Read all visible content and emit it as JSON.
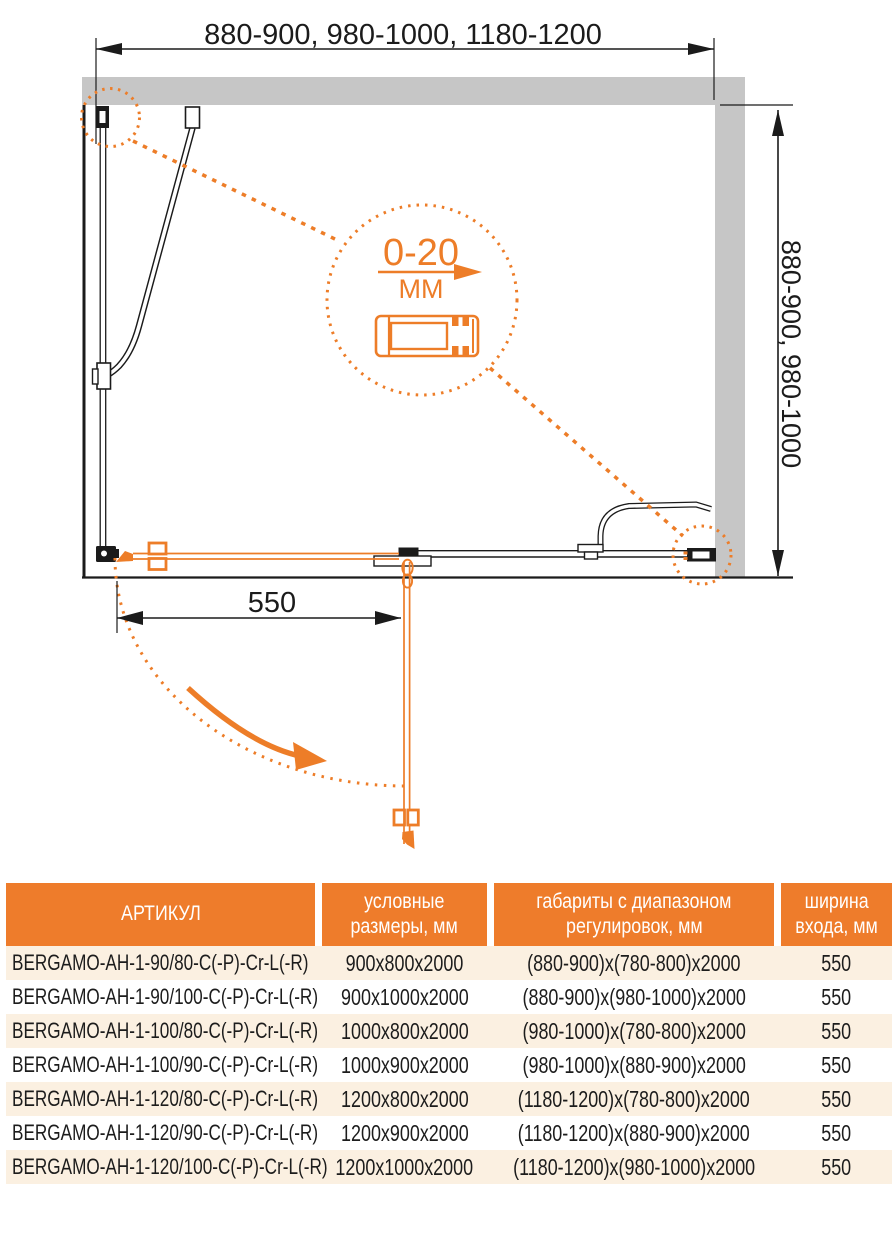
{
  "colors": {
    "accent_orange": "#ED7D28",
    "wall_gray": "#C6C6C6",
    "row_cream": "#FBF0E1",
    "line_black": "#1B1B1B"
  },
  "diagram": {
    "width_range_label": "880-900, 980-1000, 1180-1200",
    "depth_range_label": "880-900, 980-1000",
    "entry_width_label": "550",
    "adjustment_detail": {
      "range": "0-20",
      "unit": "ММ"
    }
  },
  "table": {
    "headers": {
      "article": "АРТИКУЛ",
      "size_line1": "условные",
      "size_line2": "размеры, мм",
      "range_line1": "габариты с диапазоном",
      "range_line2": "регулировок, мм",
      "entry_line1": "ширина",
      "entry_line2": "входа, мм"
    },
    "rows": [
      {
        "article": "BERGAMO-AH-1-90/80-C(-P)-Cr-L(-R)",
        "size": "900x800x2000",
        "range": "(880-900)x(780-800)x2000",
        "entry": "550"
      },
      {
        "article": "BERGAMO-AH-1-90/100-C(-P)-Cr-L(-R)",
        "size": "900x1000x2000",
        "range": "(880-900)x(980-1000)x2000",
        "entry": "550"
      },
      {
        "article": "BERGAMO-AH-1-100/80-C(-P)-Cr-L(-R)",
        "size": "1000x800x2000",
        "range": "(980-1000)x(780-800)x2000",
        "entry": "550"
      },
      {
        "article": "BERGAMO-AH-1-100/90-C(-P)-Cr-L(-R)",
        "size": "1000x900x2000",
        "range": "(980-1000)x(880-900)x2000",
        "entry": "550"
      },
      {
        "article": "BERGAMO-AH-1-120/80-C(-P)-Cr-L(-R)",
        "size": "1200x800x2000",
        "range": "(1180-1200)x(780-800)x2000",
        "entry": "550"
      },
      {
        "article": "BERGAMO-AH-1-120/90-C(-P)-Cr-L(-R)",
        "size": "1200x900x2000",
        "range": "(1180-1200)x(880-900)x2000",
        "entry": "550"
      },
      {
        "article": "BERGAMO-AH-1-120/100-C(-P)-Cr-L(-R)",
        "size": "1200x1000x2000",
        "range": "(1180-1200)x(980-1000)x2000",
        "entry": "550"
      }
    ]
  }
}
